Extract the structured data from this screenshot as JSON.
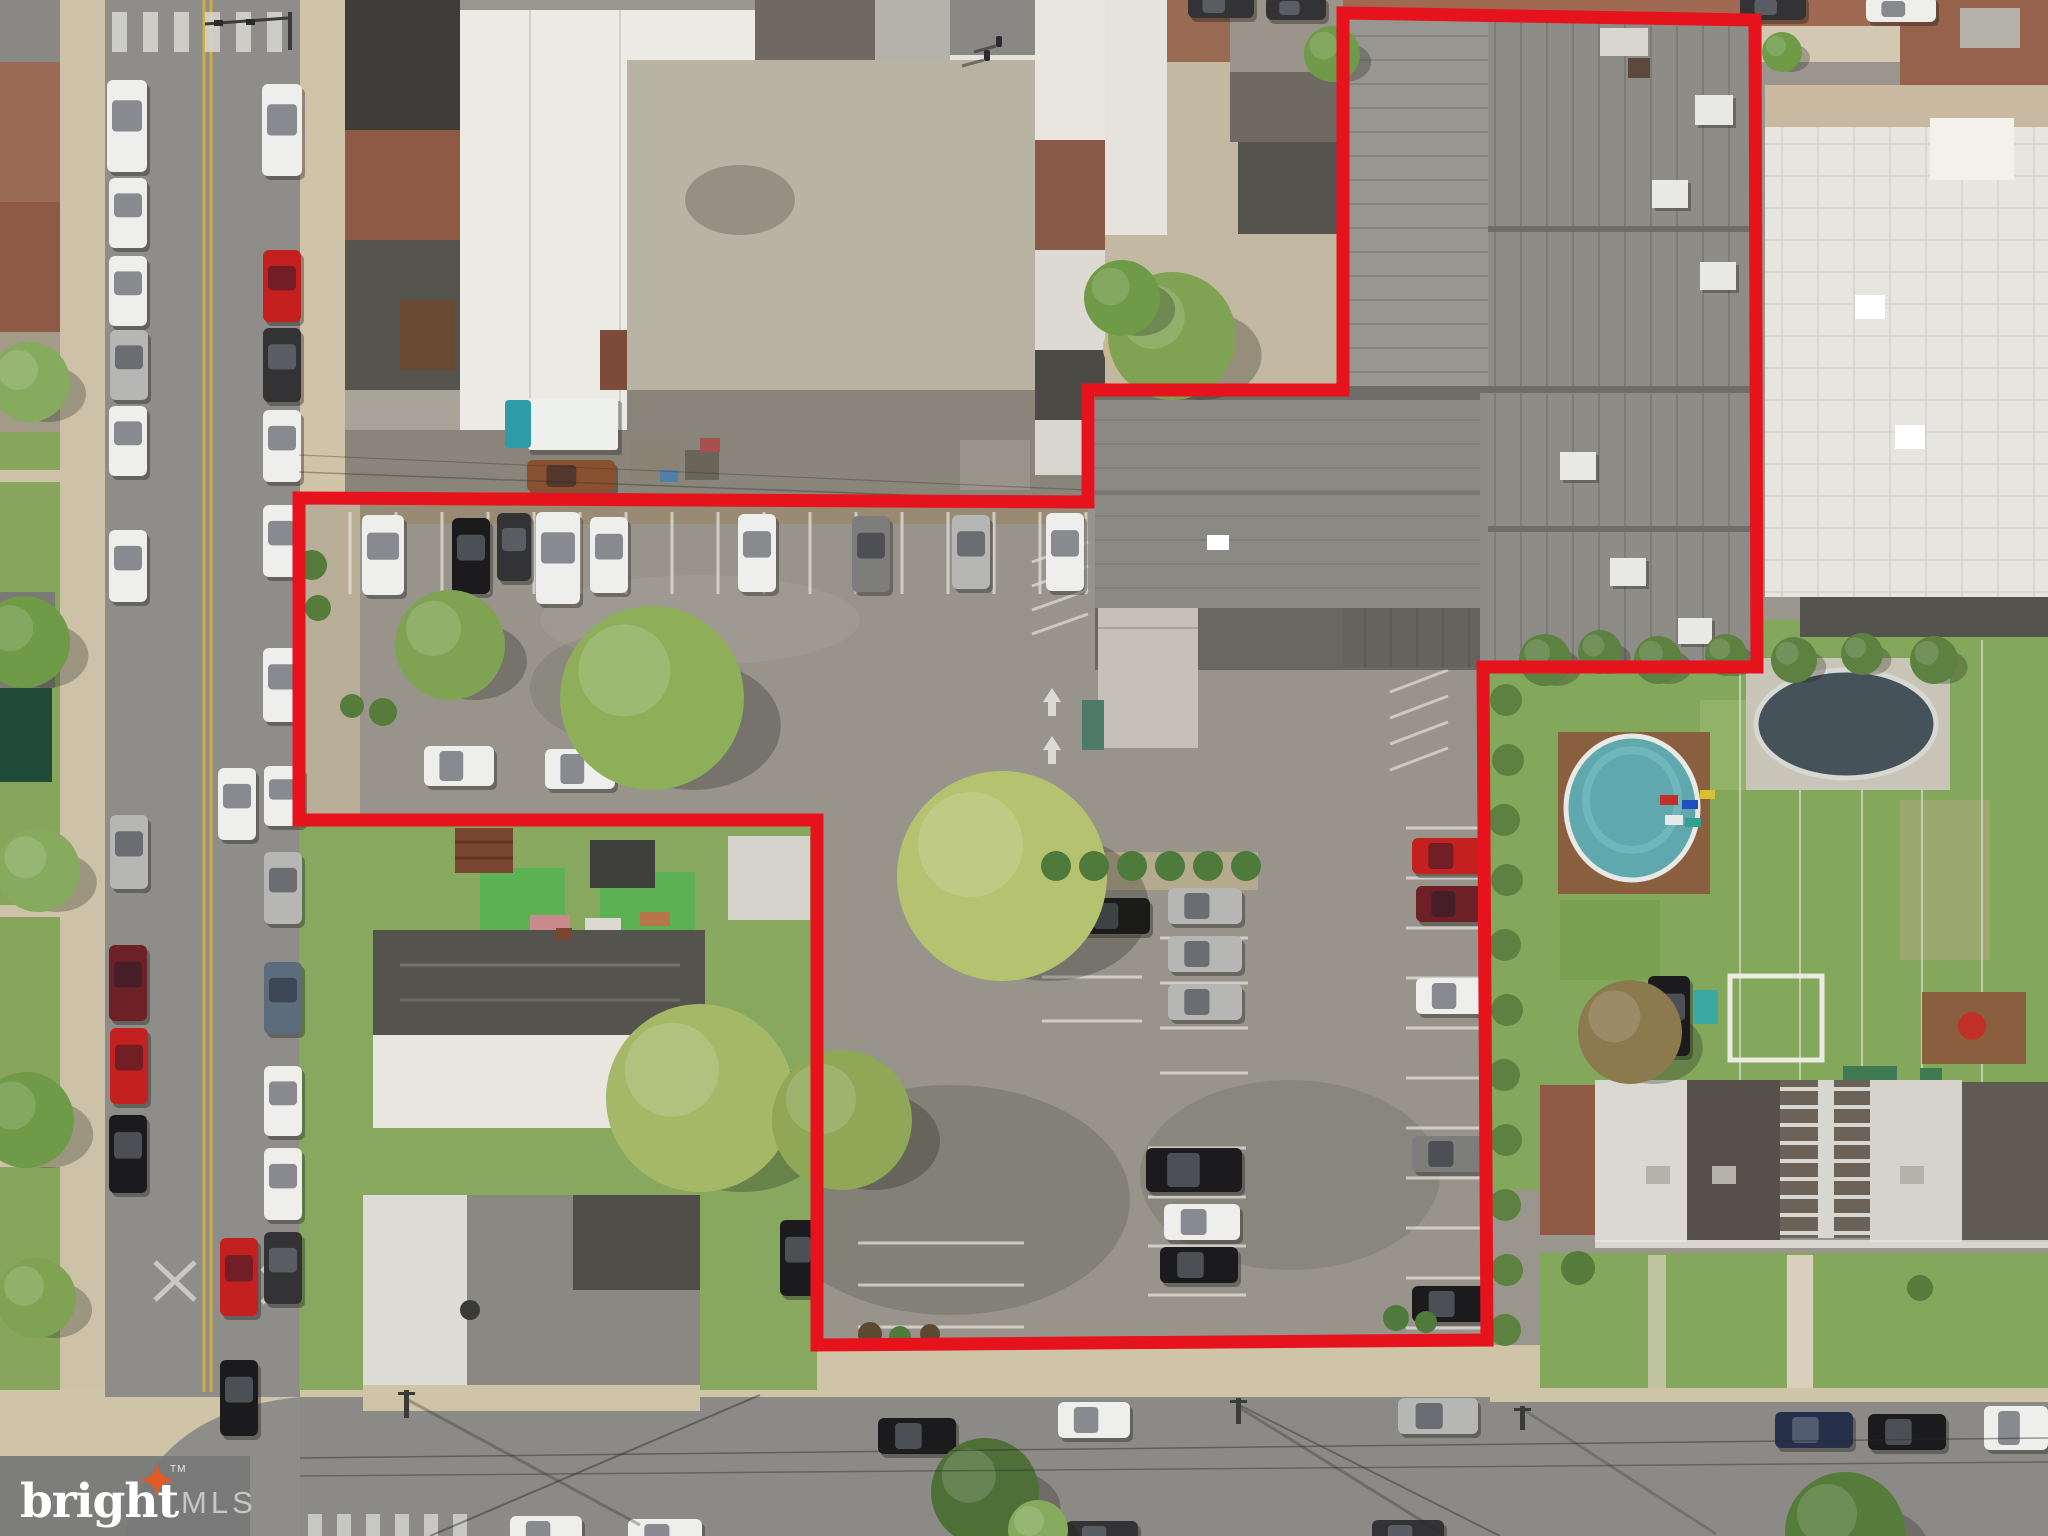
{
  "watermark": {
    "brand": "bright",
    "tm": "TM",
    "suffix": "MLS",
    "bg_color": "#787878",
    "star_color": "#e05a26",
    "brand_color": "#ffffff",
    "suffix_color": "#c6c6c6"
  },
  "boundary": {
    "points": "1343,13 1755,20 1757,667 1483,667 1487,1340 817,1345 817,820 299,820 299,498 1088,502 1088,390 1343,390",
    "color": "#e6131c",
    "width": 13
  },
  "palette": {
    "lot_asphalt": "#98948c",
    "street_asphalt": "#8f8d89",
    "bottom_street": "#8c8a86",
    "sidewalk": "#cfc3a8",
    "grass": "#83a85c",
    "brick": "#96624c",
    "top_street_brick": "#a06a52",
    "roof_white": "#eae8e0",
    "roof_dark": "#45433e",
    "big_roof_gray": "#8e8c86",
    "pool_water": "#5fa8ad",
    "stripe": "#e8e6e0",
    "yellow_line": "#d4b23c",
    "car_colors": {
      "white": "#eeeeec",
      "black": "#1b1b1d",
      "charcoal": "#333336",
      "gray": "#7d7d7b",
      "silver": "#b6b6b4",
      "red": "#c42020",
      "maroon": "#6e2027",
      "navy": "#26304a",
      "steel": "#5c6c7c",
      "brown": "#8a5130"
    }
  },
  "scene": {
    "cars": [
      {
        "x": 107,
        "y": 80,
        "o": "v",
        "c": "white",
        "l": 92,
        "w": 40
      },
      {
        "x": 109,
        "y": 178,
        "o": "v",
        "c": "white",
        "l": 70
      },
      {
        "x": 109,
        "y": 256,
        "o": "v",
        "c": "white",
        "l": 70
      },
      {
        "x": 110,
        "y": 330,
        "o": "v",
        "c": "silver",
        "l": 70
      },
      {
        "x": 109,
        "y": 406,
        "o": "v",
        "c": "white",
        "l": 70
      },
      {
        "x": 109,
        "y": 530,
        "o": "v",
        "c": "white",
        "l": 72
      },
      {
        "x": 110,
        "y": 815,
        "o": "v",
        "c": "silver",
        "l": 74
      },
      {
        "x": 109,
        "y": 945,
        "o": "v",
        "c": "maroon",
        "l": 76
      },
      {
        "x": 110,
        "y": 1028,
        "o": "v",
        "c": "red",
        "l": 76
      },
      {
        "x": 109,
        "y": 1115,
        "o": "v",
        "c": "black",
        "l": 78
      },
      {
        "x": 262,
        "y": 84,
        "o": "v",
        "c": "white",
        "l": 92,
        "w": 40
      },
      {
        "x": 263,
        "y": 250,
        "o": "v",
        "c": "red",
        "l": 72
      },
      {
        "x": 263,
        "y": 328,
        "o": "v",
        "c": "charcoal",
        "l": 74
      },
      {
        "x": 263,
        "y": 410,
        "o": "v",
        "c": "white",
        "l": 72
      },
      {
        "x": 263,
        "y": 505,
        "o": "v",
        "c": "white",
        "l": 72
      },
      {
        "x": 263,
        "y": 648,
        "o": "v",
        "c": "white",
        "l": 74
      },
      {
        "x": 264,
        "y": 766,
        "o": "v",
        "c": "white",
        "l": 60,
        "w": 40
      },
      {
        "x": 264,
        "y": 852,
        "o": "v",
        "c": "silver",
        "l": 72
      },
      {
        "x": 264,
        "y": 962,
        "o": "v",
        "c": "steel",
        "l": 72
      },
      {
        "x": 264,
        "y": 1066,
        "o": "v",
        "c": "white",
        "l": 70
      },
      {
        "x": 264,
        "y": 1148,
        "o": "v",
        "c": "white",
        "l": 72
      },
      {
        "x": 264,
        "y": 1232,
        "o": "v",
        "c": "charcoal",
        "l": 72
      },
      {
        "x": 218,
        "y": 768,
        "o": "v",
        "c": "white",
        "l": 72
      },
      {
        "x": 220,
        "y": 1238,
        "o": "v",
        "c": "red",
        "l": 78
      },
      {
        "x": 220,
        "y": 1360,
        "o": "v",
        "c": "black",
        "l": 76
      },
      {
        "x": 362,
        "y": 515,
        "o": "v",
        "c": "white",
        "l": 80,
        "w": 42
      },
      {
        "x": 452,
        "y": 518,
        "o": "v",
        "c": "black",
        "l": 76
      },
      {
        "x": 497,
        "y": 513,
        "o": "v",
        "c": "charcoal",
        "l": 68,
        "w": 34
      },
      {
        "x": 536,
        "y": 512,
        "o": "v",
        "c": "white",
        "l": 92,
        "w": 44
      },
      {
        "x": 590,
        "y": 517,
        "o": "v",
        "c": "white",
        "l": 76
      },
      {
        "x": 738,
        "y": 514,
        "o": "v",
        "c": "white",
        "l": 78
      },
      {
        "x": 852,
        "y": 516,
        "o": "v",
        "c": "gray",
        "l": 76
      },
      {
        "x": 952,
        "y": 515,
        "o": "v",
        "c": "silver",
        "l": 74
      },
      {
        "x": 1046,
        "y": 513,
        "o": "v",
        "c": "white",
        "l": 78
      },
      {
        "x": 424,
        "y": 746,
        "o": "h",
        "c": "white",
        "l": 70,
        "w": 40
      },
      {
        "x": 545,
        "y": 749,
        "o": "h",
        "c": "white",
        "l": 70,
        "w": 40
      },
      {
        "x": 1078,
        "y": 898,
        "o": "h",
        "c": "black",
        "l": 72
      },
      {
        "x": 1168,
        "y": 888,
        "o": "h",
        "c": "silver",
        "l": 74
      },
      {
        "x": 1168,
        "y": 936,
        "o": "h",
        "c": "silver",
        "l": 74
      },
      {
        "x": 1168,
        "y": 984,
        "o": "h",
        "c": "silver",
        "l": 74
      },
      {
        "x": 1146,
        "y": 1148,
        "o": "h",
        "c": "black",
        "l": 96,
        "w": 44
      },
      {
        "x": 1164,
        "y": 1204,
        "o": "h",
        "c": "white",
        "l": 76
      },
      {
        "x": 1160,
        "y": 1247,
        "o": "h",
        "c": "black",
        "l": 78
      },
      {
        "x": 1412,
        "y": 838,
        "o": "h",
        "c": "red",
        "l": 74
      },
      {
        "x": 1416,
        "y": 886,
        "o": "h",
        "c": "maroon",
        "l": 70
      },
      {
        "x": 1416,
        "y": 978,
        "o": "h",
        "c": "white",
        "l": 72
      },
      {
        "x": 1412,
        "y": 1136,
        "o": "h",
        "c": "gray",
        "l": 74
      },
      {
        "x": 1412,
        "y": 1286,
        "o": "h",
        "c": "black",
        "l": 76
      },
      {
        "x": 780,
        "y": 1220,
        "o": "v",
        "c": "black",
        "l": 76,
        "w": 36
      },
      {
        "x": 527,
        "y": 460,
        "o": "h",
        "c": "brown",
        "l": 88,
        "w": 32
      },
      {
        "x": 1648,
        "y": 976,
        "o": "v",
        "c": "black",
        "l": 80,
        "w": 42
      },
      {
        "x": 878,
        "y": 1418,
        "o": "h",
        "c": "black",
        "l": 78
      },
      {
        "x": 1058,
        "y": 1402,
        "o": "h",
        "c": "white",
        "l": 72
      },
      {
        "x": 1398,
        "y": 1398,
        "o": "h",
        "c": "silver",
        "l": 80
      },
      {
        "x": 1775,
        "y": 1412,
        "o": "h",
        "c": "navy",
        "l": 78
      },
      {
        "x": 1868,
        "y": 1414,
        "o": "h",
        "c": "black",
        "l": 78
      },
      {
        "x": 1984,
        "y": 1406,
        "o": "h",
        "c": "white",
        "l": 64,
        "w": 44
      },
      {
        "x": 510,
        "y": 1516,
        "o": "h",
        "c": "white",
        "l": 72
      },
      {
        "x": 628,
        "y": 1519,
        "o": "h",
        "c": "white",
        "l": 74
      },
      {
        "x": 1066,
        "y": 1521,
        "o": "h",
        "c": "charcoal",
        "l": 72
      },
      {
        "x": 1372,
        "y": 1520,
        "o": "h",
        "c": "charcoal",
        "l": 72
      },
      {
        "x": 1188,
        "y": -8,
        "o": "h",
        "c": "charcoal",
        "l": 66,
        "w": 26
      },
      {
        "x": 1266,
        "y": -4,
        "o": "h",
        "c": "charcoal",
        "l": 60,
        "w": 24
      },
      {
        "x": 1740,
        "y": -6,
        "o": "h",
        "c": "charcoal",
        "l": 66,
        "w": 26
      },
      {
        "x": 1866,
        "y": -4,
        "o": "h",
        "c": "white",
        "l": 70,
        "w": 26
      }
    ],
    "trees": [
      {
        "x": 450,
        "y": 645,
        "r": 55,
        "c": "#7fa352"
      },
      {
        "x": 652,
        "y": 698,
        "r": 92,
        "c": "#8fae5a"
      },
      {
        "x": 1002,
        "y": 876,
        "r": 105,
        "c": "#b5c370"
      },
      {
        "x": 700,
        "y": 1098,
        "r": 94,
        "c": "#a4b868"
      },
      {
        "x": 842,
        "y": 1120,
        "r": 70,
        "c": "#8fa757"
      },
      {
        "x": 1172,
        "y": 336,
        "r": 64,
        "c": "#7fa352"
      },
      {
        "x": 1122,
        "y": 298,
        "r": 38,
        "c": "#6f9a48"
      },
      {
        "x": 30,
        "y": 382,
        "r": 40,
        "c": "#86aa5e"
      },
      {
        "x": 24,
        "y": 642,
        "r": 46,
        "c": "#6f9a48"
      },
      {
        "x": 38,
        "y": 870,
        "r": 42,
        "c": "#86aa5e"
      },
      {
        "x": 26,
        "y": 1120,
        "r": 48,
        "c": "#6f9a48"
      },
      {
        "x": 36,
        "y": 1298,
        "r": 40,
        "c": "#7fa352"
      },
      {
        "x": 985,
        "y": 1492,
        "r": 54,
        "c": "#4e7038"
      },
      {
        "x": 1845,
        "y": 1532,
        "r": 60,
        "c": "#567c3c"
      },
      {
        "x": 1038,
        "y": 1530,
        "r": 30,
        "c": "#86aa5e"
      },
      {
        "x": 1332,
        "y": 54,
        "r": 28,
        "c": "#6f9a48"
      },
      {
        "x": 1782,
        "y": 52,
        "r": 20,
        "c": "#6f9a48"
      },
      {
        "x": 1630,
        "y": 1032,
        "r": 52,
        "c": "#8a7a4e"
      },
      {
        "x": 1545,
        "y": 660,
        "r": 26,
        "c": "#5d8140"
      },
      {
        "x": 1600,
        "y": 652,
        "r": 22,
        "c": "#5d8140"
      },
      {
        "x": 1658,
        "y": 660,
        "r": 24,
        "c": "#5d8140"
      },
      {
        "x": 1726,
        "y": 655,
        "r": 21,
        "c": "#5d8140"
      },
      {
        "x": 1794,
        "y": 660,
        "r": 23,
        "c": "#5d8140"
      },
      {
        "x": 1862,
        "y": 654,
        "r": 21,
        "c": "#5d8140"
      },
      {
        "x": 1934,
        "y": 660,
        "r": 24,
        "c": "#5d8140"
      }
    ],
    "bushes": [
      {
        "x": 1056,
        "y": 866,
        "r": 15,
        "c": "#4e7a3c"
      },
      {
        "x": 1094,
        "y": 866,
        "r": 15,
        "c": "#4e7a3c"
      },
      {
        "x": 1132,
        "y": 866,
        "r": 15,
        "c": "#4e7a3c"
      },
      {
        "x": 1170,
        "y": 866,
        "r": 15,
        "c": "#4e7a3c"
      },
      {
        "x": 1208,
        "y": 866,
        "r": 15,
        "c": "#4e7a3c"
      },
      {
        "x": 1246,
        "y": 866,
        "r": 15,
        "c": "#4e7a3c"
      },
      {
        "x": 1506,
        "y": 700,
        "r": 16,
        "c": "#5d8140"
      },
      {
        "x": 1508,
        "y": 760,
        "r": 16,
        "c": "#5d8140"
      },
      {
        "x": 1504,
        "y": 820,
        "r": 16,
        "c": "#5d8140"
      },
      {
        "x": 1507,
        "y": 880,
        "r": 16,
        "c": "#5d8140"
      },
      {
        "x": 1505,
        "y": 945,
        "r": 16,
        "c": "#5d8140"
      },
      {
        "x": 1507,
        "y": 1010,
        "r": 16,
        "c": "#5d8140"
      },
      {
        "x": 1504,
        "y": 1075,
        "r": 16,
        "c": "#5d8140"
      },
      {
        "x": 1506,
        "y": 1140,
        "r": 16,
        "c": "#5d8140"
      },
      {
        "x": 1505,
        "y": 1205,
        "r": 16,
        "c": "#5d8140"
      },
      {
        "x": 1507,
        "y": 1270,
        "r": 16,
        "c": "#5d8140"
      },
      {
        "x": 1505,
        "y": 1330,
        "r": 16,
        "c": "#5d8140"
      },
      {
        "x": 870,
        "y": 1334,
        "r": 12,
        "c": "#5c4a30"
      },
      {
        "x": 900,
        "y": 1337,
        "r": 11,
        "c": "#4e7a3c"
      },
      {
        "x": 930,
        "y": 1334,
        "r": 10,
        "c": "#5c4a30"
      },
      {
        "x": 1396,
        "y": 1318,
        "r": 13,
        "c": "#4e7a3c"
      },
      {
        "x": 1426,
        "y": 1322,
        "r": 11,
        "c": "#4e7a3c"
      },
      {
        "x": 312,
        "y": 565,
        "r": 15,
        "c": "#567c3c"
      },
      {
        "x": 318,
        "y": 608,
        "r": 13,
        "c": "#567c3c"
      },
      {
        "x": 383,
        "y": 712,
        "r": 14,
        "c": "#567c3c"
      },
      {
        "x": 352,
        "y": 706,
        "r": 12,
        "c": "#567c3c"
      },
      {
        "x": 1578,
        "y": 1268,
        "r": 17,
        "c": "#567c3c"
      },
      {
        "x": 1920,
        "y": 1288,
        "r": 13,
        "c": "#567c3c"
      }
    ],
    "stripes": [
      {
        "dir": "v",
        "x": 350,
        "y": 512,
        "step": 46,
        "n": 17,
        "len": 82
      },
      {
        "dir": "h",
        "x": 1406,
        "y": 828,
        "step": 50,
        "n": 11,
        "len": 82
      },
      {
        "dir": "h",
        "x": 1042,
        "y": 933,
        "step": 44,
        "n": 3,
        "len": 100
      },
      {
        "dir": "h",
        "x": 1160,
        "y": 938,
        "step": 45,
        "n": 4,
        "len": 88
      },
      {
        "dir": "h",
        "x": 1148,
        "y": 1148,
        "step": 49,
        "n": 4,
        "len": 98
      },
      {
        "dir": "h",
        "x": 858,
        "y": 1243,
        "step": 42,
        "n": 3,
        "len": 166
      }
    ],
    "hatches": [
      {
        "x": 1032,
        "y": 562,
        "step": 24,
        "n": 4,
        "dx": 56,
        "dy": -20
      },
      {
        "x": 1390,
        "y": 692,
        "step": 26,
        "n": 4,
        "dx": 58,
        "dy": -22
      }
    ],
    "arrows": [
      {
        "x": 1052,
        "y": 688
      },
      {
        "x": 1052,
        "y": 736
      }
    ]
  }
}
